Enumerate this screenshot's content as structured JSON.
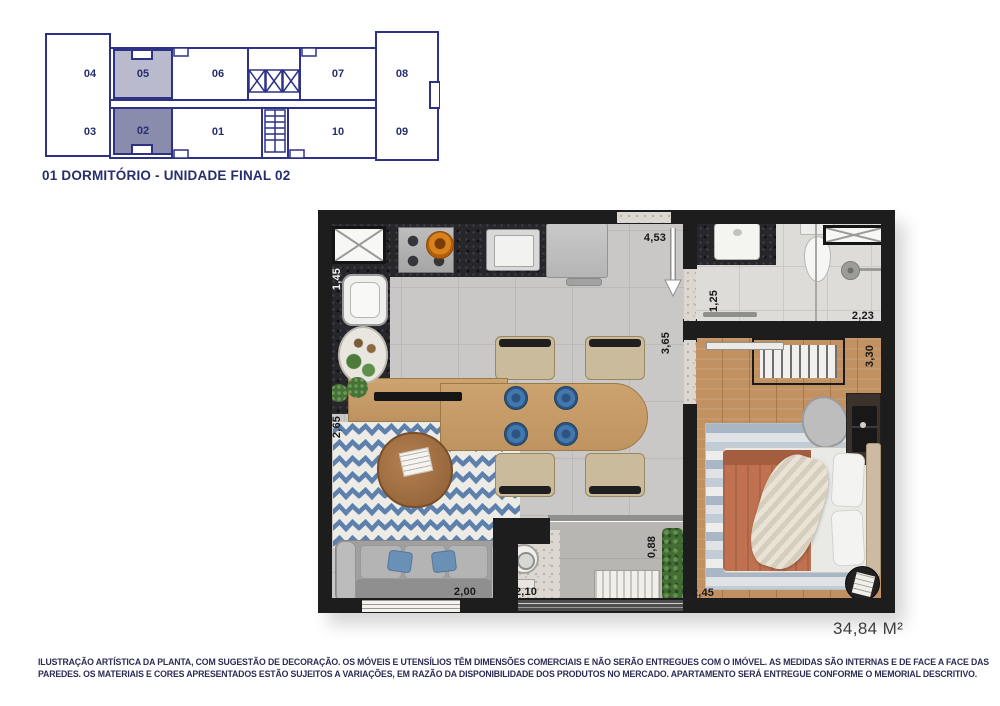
{
  "key_plan": {
    "units_top": [
      "04",
      "05",
      "06",
      "07",
      "08"
    ],
    "units_bottom": [
      "03",
      "02",
      "01",
      "10",
      "09"
    ]
  },
  "title": "01 DORMITÓRIO - UNIDADE FINAL 02",
  "plan": {
    "dims": {
      "entry": "4,53",
      "kitchen_side": "1,45",
      "bath_entry": "1,25",
      "bath_width": "2,23",
      "living_depth": "3,65",
      "closet": "3,30",
      "living_width": "2,65",
      "sofa": "2,00",
      "laundry": "2,10",
      "balcony": "0,88",
      "bedroom": "2,45"
    },
    "area": "34,84 M²"
  },
  "disclaimer": {
    "line1": "ILUSTRAÇÃO ARTÍSTICA DA PLANTA, COM SUGESTÃO DE DECORAÇÃO. OS MÓVEIS E UTENSÍLIOS TÊM DIMENSÕES COMERCIAIS E NÃO SERÃO ENTREGUES COM O IMÓVEL. AS MEDIDAS SÃO INTERNAS E DE FACE A FACE DAS",
    "line2": "PAREDES. OS MATERIAIS E CORES APRESENTADOS ESTÃO SUJEITOS A VARIAÇÕES, EM RAZÃO DA DISPONIBILIDADE DOS PRODUTOS NO MERCADO. APARTAMENTO SERÁ ENTREGUE CONFORME O MEMORIAL DESCRITIVO."
  },
  "colors": {
    "keyplan_line": "#2e3287",
    "unit_02_fill": "#8a8cad",
    "unit_05_fill": "#b9bacd",
    "wall": "#1d1d1d",
    "rug_accent": "#5e80ac",
    "bed_accent": "#c0714f"
  }
}
